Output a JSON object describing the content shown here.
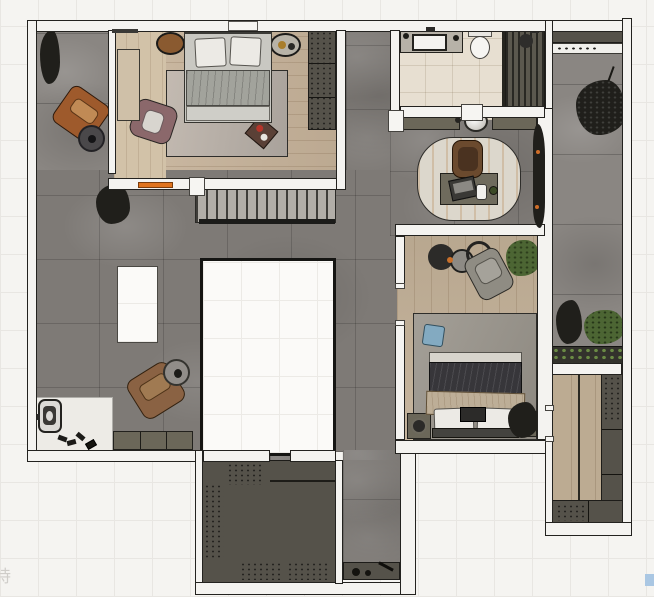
{
  "watermark": {
    "text": "持"
  },
  "artifact": {
    "name": "selection-square",
    "color": "#aac7e3"
  },
  "palette": {
    "bg": "#f5f4f1",
    "grid": "#e8e6e2",
    "wallF": "#f4f3f0",
    "wallL": "#23221f",
    "concrete": "#7e7a76",
    "concreteB": "#8a8682",
    "wood1": "#c6b299",
    "wood1l": "#d2c2a8",
    "wood2": "#c2b097",
    "woodc": "#bcab92",
    "bath": "#e7dfd1",
    "marble": "#edebe6",
    "olive": "#6b6759",
    "oliveD": "#55524a",
    "stair": "#b2aea8",
    "voidB": "#151513",
    "rug1": "#b8afa7",
    "rug2": "#99948b",
    "rugO": "#dcd7cc",
    "orange": "#e0731d",
    "leather": "#9e5a2c",
    "mauve": "#8b686b",
    "brownC": "#8a6243",
    "officeC": "#6b4a2e",
    "grayC": "#8f8c83",
    "plantD": "#201f1b",
    "plantG": "#4c6533",
    "duvetG": "#a2a39c",
    "duvetD": "#37363a",
    "throw": "#bdae97",
    "pillow": "#eceae5",
    "pillowB": "#83aac1",
    "bench": "#44433f",
    "watermark": "#c6c4c0",
    "blueSq": "#aac7e3"
  },
  "legend": {
    "rooms": [
      "balcony-top-left",
      "bedroom-top-left",
      "hallway-core",
      "study-area",
      "bathroom",
      "shower",
      "bedroom-right",
      "balcony-right",
      "walk-in-closet-right",
      "dressing-room-bottom",
      "corridor-bottom",
      "entry-nook",
      "stair-run",
      "floor-opening-large",
      "floor-opening-small"
    ],
    "furniture": [
      "double-bed",
      "pillow",
      "area-rug",
      "wardrobe",
      "nightstand-decor",
      "accent-armchair",
      "side-table",
      "writing-desk",
      "desk-chair",
      "laptop",
      "cup",
      "toilet",
      "vanity-basin",
      "console-basin",
      "shower-head",
      "potted-tree",
      "shrub",
      "planter-box",
      "storage-cabinet",
      "shoe-cabinet",
      "intercom-panel",
      "coffee-table",
      "throw-blanket",
      "storage-bench",
      "tray"
    ]
  }
}
